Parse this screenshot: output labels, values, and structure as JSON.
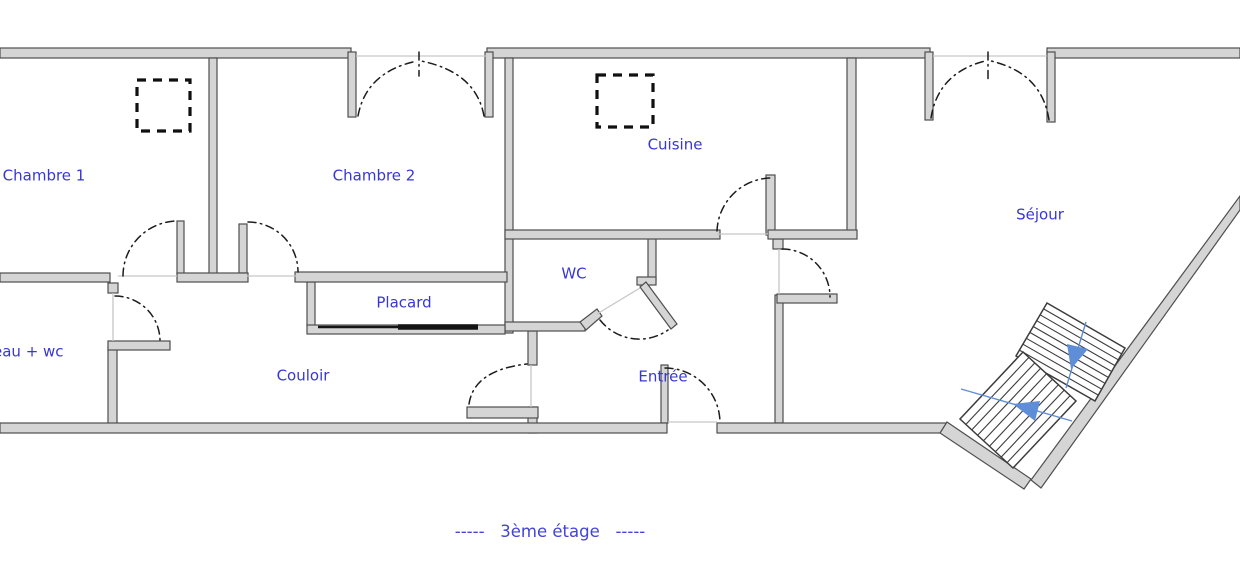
{
  "caption": {
    "text": "-----   3ème étage   -----"
  },
  "rooms": [
    {
      "id": "chambre-1",
      "label": "Chambre 1",
      "x": 44,
      "y": 176,
      "anchor": "center"
    },
    {
      "id": "chambre-2",
      "label": "Chambre 2",
      "x": 374,
      "y": 176,
      "anchor": "center"
    },
    {
      "id": "cuisine",
      "label": "Cuisine",
      "x": 675,
      "y": 145,
      "anchor": "center"
    },
    {
      "id": "sejour",
      "label": "Séjour",
      "x": 1040,
      "y": 215,
      "anchor": "center"
    },
    {
      "id": "wc",
      "label": "WC",
      "x": 574,
      "y": 274,
      "anchor": "center"
    },
    {
      "id": "placard",
      "label": "Placard",
      "x": 404,
      "y": 303,
      "anchor": "center"
    },
    {
      "id": "couloir",
      "label": "Couloir",
      "x": 303,
      "y": 376,
      "anchor": "center"
    },
    {
      "id": "entree",
      "label": "Entrée",
      "x": 663,
      "y": 377,
      "anchor": "center"
    },
    {
      "id": "salle-eau-wc",
      "label": "eau + wc",
      "x": -7,
      "y": 352,
      "anchor": "left"
    }
  ],
  "stairs": {
    "flights": 2,
    "direction_arrows": 2
  },
  "symbols": {
    "duct_squares": 2,
    "door_swing_arcs": 12,
    "double_door_openings": 2
  },
  "colors": {
    "wall_fill": "#d5d5d5",
    "wall_stroke": "#4e4e4e",
    "thin_line": "#c7c7c7",
    "arc_ink": "#1c1c1c",
    "square_ink": "#101010",
    "stair_ink": "#3c3c3c",
    "stair_blue": "#5f8ed8",
    "label_ink": "#3737d2",
    "caption_ink": "#4343d6",
    "background": "#ffffff"
  }
}
